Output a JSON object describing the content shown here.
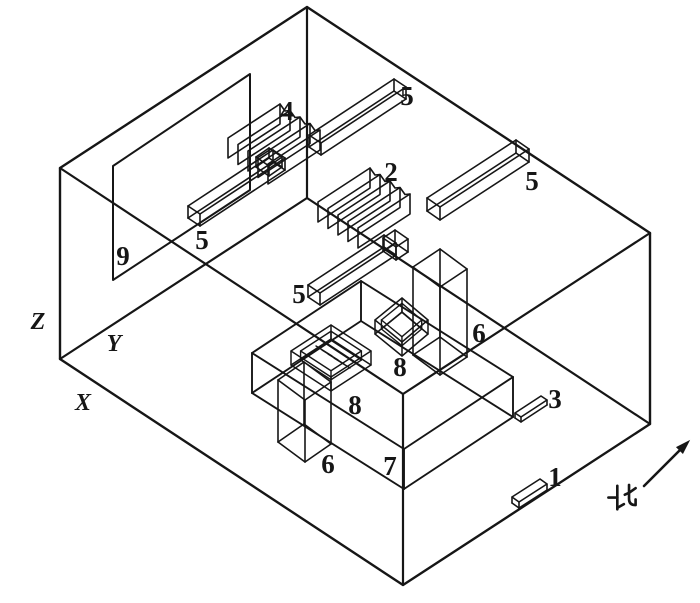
{
  "diagram": {
    "canvas": {
      "width": 700,
      "height": 603,
      "background": "#ffffff",
      "line_color": "#161616"
    },
    "axis_labels": [
      {
        "text": "Z",
        "x": 38,
        "y": 322
      },
      {
        "text": "Y",
        "x": 114,
        "y": 344
      },
      {
        "text": "X",
        "x": 83,
        "y": 403
      }
    ],
    "part_labels": [
      {
        "text": "4",
        "x": 287,
        "y": 111
      },
      {
        "text": "5",
        "x": 407,
        "y": 96
      },
      {
        "text": "5",
        "x": 202,
        "y": 240
      },
      {
        "text": "5",
        "x": 299,
        "y": 294
      },
      {
        "text": "5",
        "x": 532,
        "y": 181
      },
      {
        "text": "2",
        "x": 391,
        "y": 172
      },
      {
        "text": "9",
        "x": 123,
        "y": 256
      },
      {
        "text": "6",
        "x": 328,
        "y": 464
      },
      {
        "text": "6",
        "x": 479,
        "y": 333
      },
      {
        "text": "8",
        "x": 355,
        "y": 405
      },
      {
        "text": "8",
        "x": 400,
        "y": 367
      },
      {
        "text": "7",
        "x": 390,
        "y": 466
      },
      {
        "text": "3",
        "x": 555,
        "y": 399
      },
      {
        "text": "1",
        "x": 555,
        "y": 477
      }
    ],
    "north": {
      "text": "北",
      "cx": 622,
      "cy": 498,
      "size": 30,
      "arrow": {
        "from": [
          644,
          486
        ],
        "to": [
          680,
          450
        ],
        "head": [
          [
            689,
            441
          ],
          [
            682.8,
            453.2
          ],
          [
            676.8,
            447.2
          ]
        ]
      }
    },
    "room": {
      "outline": [
        [
          60,
          168
        ],
        [
          307,
          7
        ],
        [
          650,
          233
        ],
        [
          650,
          424
        ],
        [
          403,
          585
        ],
        [
          60,
          359
        ]
      ],
      "inner_edges": [
        [
          [
            307,
            7
          ],
          [
            307,
            198
          ]
        ],
        [
          [
            307,
            198
          ],
          [
            60,
            359
          ]
        ],
        [
          [
            307,
            198
          ],
          [
            650,
            424
          ]
        ],
        [
          [
            403,
            585
          ],
          [
            403,
            394
          ]
        ],
        [
          [
            403,
            394
          ],
          [
            60,
            168
          ]
        ],
        [
          [
            403,
            394
          ],
          [
            650,
            233
          ]
        ]
      ]
    },
    "panel_9": [
      [
        113,
        280
      ],
      [
        113,
        166
      ],
      [
        250,
        74
      ],
      [
        250,
        190
      ]
    ],
    "boxes": [
      {
        "name": "cabinet-7",
        "p": [
          252,
          393
        ],
        "u": [
          152,
          96
        ],
        "v": [
          109,
          -72
        ],
        "w": [
          0,
          -40
        ]
      },
      {
        "name": "column-6-left",
        "p": [
          278,
          442
        ],
        "u": [
          27,
          20
        ],
        "v": [
          26,
          -18
        ],
        "w": [
          0,
          -62
        ]
      },
      {
        "name": "column-6-right",
        "p": [
          413,
          355
        ],
        "u": [
          27,
          20
        ],
        "v": [
          27,
          -18
        ],
        "w": [
          0,
          -88
        ]
      },
      {
        "name": "lamp-5-wall-left",
        "p": [
          188,
          218
        ],
        "u": [
          12,
          8
        ],
        "v": [
          85,
          -56
        ],
        "w": [
          0,
          -12
        ]
      },
      {
        "name": "lamp-5-wall-right",
        "p": [
          309,
          147
        ],
        "u": [
          12,
          8
        ],
        "v": [
          85,
          -56
        ],
        "w": [
          0,
          -12
        ]
      },
      {
        "name": "lamp-5-mid-left",
        "p": [
          308,
          297
        ],
        "u": [
          12,
          8
        ],
        "v": [
          76,
          -50
        ],
        "w": [
          0,
          -12
        ]
      },
      {
        "name": "lamp-5-mid-right",
        "p": [
          427,
          211
        ],
        "u": [
          13,
          9
        ],
        "v": [
          89,
          -58
        ],
        "w": [
          0,
          -13
        ]
      },
      {
        "name": "junction-block-4",
        "p": [
          256,
          167
        ],
        "u": [
          13,
          9
        ],
        "v": [
          13,
          -9
        ],
        "w": [
          0,
          -10
        ]
      },
      {
        "name": "junction-block-2",
        "p": [
          383,
          251
        ],
        "u": [
          13,
          9
        ],
        "v": [
          12,
          -8
        ],
        "w": [
          0,
          -13
        ]
      }
    ],
    "open_boxes": [
      {
        "name": "box-8-left",
        "rim": [
          [
            291,
            351
          ],
          [
            331,
            325
          ],
          [
            371,
            351
          ],
          [
            331,
            377
          ]
        ],
        "depth": 14,
        "shrink": 0.76,
        "drop": 9
      },
      {
        "name": "box-8-right",
        "rim": [
          [
            375,
            320
          ],
          [
            402,
            298
          ],
          [
            428,
            320
          ],
          [
            402,
            342
          ]
        ],
        "depth": 14,
        "shrink": 0.76,
        "drop": 9
      }
    ],
    "radiators": [
      {
        "name": "radiator-4",
        "b0": [
          228,
          158
        ],
        "step": [
          10,
          6.5
        ],
        "len": [
          52,
          -34
        ],
        "h": 20,
        "n": 5
      },
      {
        "name": "radiator-2",
        "b0": [
          318,
          222
        ],
        "step": [
          10,
          6.5
        ],
        "len": [
          52,
          -34
        ],
        "h": 20,
        "n": 5
      }
    ],
    "grille": {
      "start": [
        316,
        346
      ],
      "seg": [
        16,
        10
      ],
      "step": [
        6,
        4
      ],
      "n": 4
    },
    "plates": [
      {
        "name": "plate-1",
        "top": [
          [
            512,
            497
          ],
          [
            540,
            479
          ],
          [
            547,
            484
          ],
          [
            519,
            502
          ]
        ],
        "th": 6
      },
      {
        "name": "plate-3",
        "top": [
          [
            515,
            413
          ],
          [
            541,
            396
          ],
          [
            547,
            400
          ],
          [
            521,
            417
          ]
        ],
        "th": 5
      }
    ],
    "north_glyph_paths": [
      "M11 3 L11 28",
      "M1.5 15.5 L11 15.5",
      "M11 26.5 L18 22.5",
      "M23.5 2 L23.5 17 Q23.5 23.5 30.5 23.5 L30.5 17.5",
      "M30.5 5.5 L23.5 10.5 L19 12.5"
    ]
  }
}
